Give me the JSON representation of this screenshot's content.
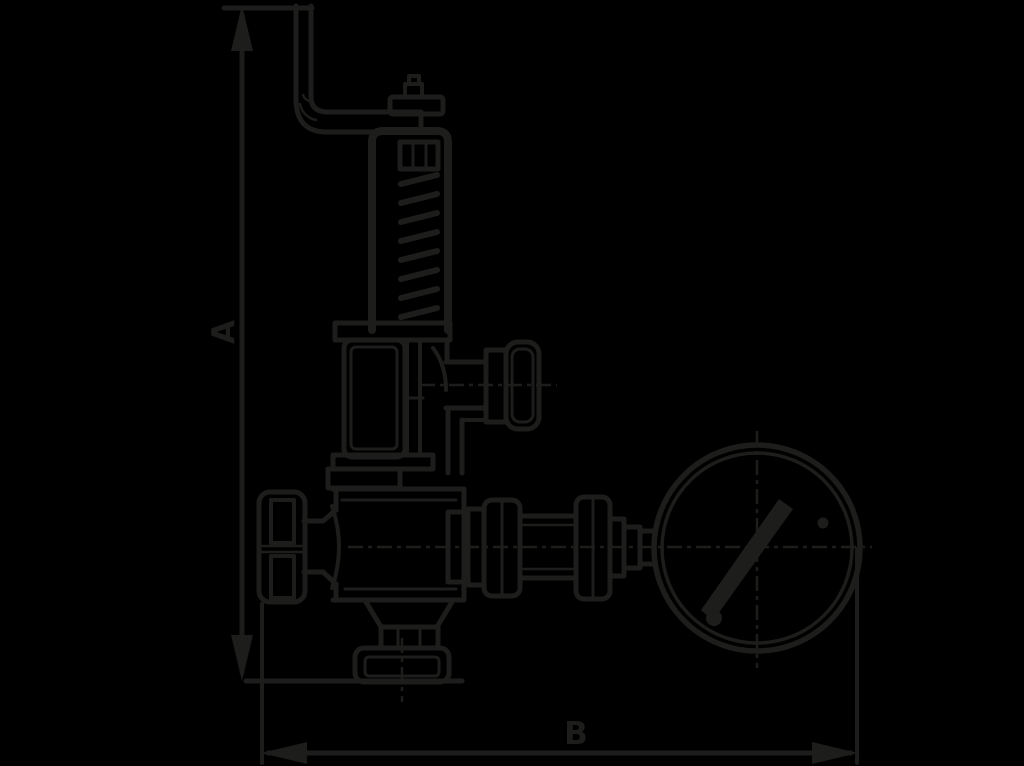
{
  "canvas": {
    "width": 1024,
    "height": 766,
    "background": "#000000",
    "ink": "#1d1d1b"
  },
  "diagram": {
    "type": "technical-line-drawing",
    "subject": "Spring-loaded safety relief valve with lifting lever and pressure gauge, side elevation",
    "dimensions": {
      "vertical": {
        "label": "A"
      },
      "horizontal": {
        "label": "B"
      }
    },
    "parts": [
      "lifting-lever",
      "spindle-cap",
      "spring-bonnet-yoke",
      "spring",
      "spring-housing",
      "outlet-port-cap",
      "valve-body",
      "side-handwheel-cap",
      "inlet-flange",
      "gauge-connection-fittings",
      "pressure-gauge"
    ]
  }
}
